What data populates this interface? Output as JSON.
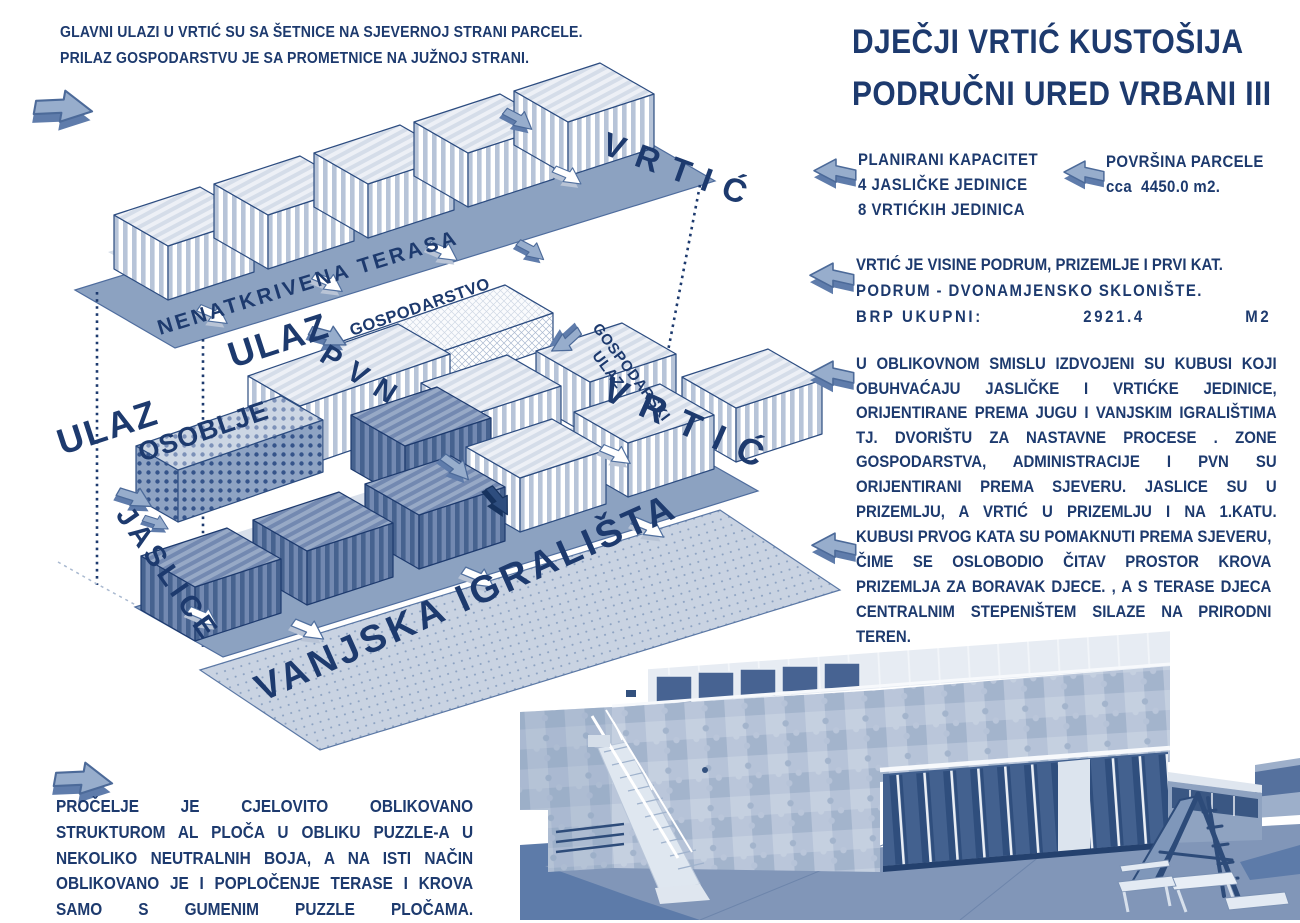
{
  "title": {
    "line1": "DJEČJI VRTIĆ KUSTOŠIJA",
    "line2": "PODRUČNI URED VRBANI III"
  },
  "notes": {
    "top_left": {
      "line1": "GLAVNI ULAZI U VRTIĆ SU SA ŠETNICE NA SJEVERNOJ STRANI PARCELE.",
      "line2": "PRILAZ GOSPODARSTVU JE SA PROMETNICE NA JUŽNOJ STRANI."
    },
    "capacity": {
      "line1": "PLANIRANI KAPACITET",
      "line2": "4 JASLIČKE JEDINICE",
      "line3": "8 VRTIĆKIH JEDINICA"
    },
    "area": {
      "line1": "POVRŠINA PARCELE",
      "line2": "cca  4450.0 m2."
    },
    "floors": {
      "line1": "VRTIĆ JE VISINE PODRUM, PRIZEMLJE I PRVI KAT.",
      "line2": "PODRUM - DVONAMJENSKO SKLONIŠTE.",
      "line3_label": "BRP UKUPNI:",
      "line3_value": "2921.4",
      "line3_unit": "M2"
    },
    "massing": {
      "text": "U OBLIKOVNOM SMISLU IZDVOJENI SU KUBUSI KOJI OBUHVAĆAJU JASLIČKE I VRTIĆKE JEDINICE, ORIJENTIRANE PREMA JUGU I VANJSKIM IGRALIŠTIMA TJ. DVORIŠTU ZA NASTAVNE PROCESE . ZONE GOSPODARSTVA, ADMINISTRACIJE I PVN SU ORIJENTIRANI PREMA SJEVERU. JASLICE SU U PRIZEMLJU, A VRTIĆ U PRIZEMLJU I NA 1.KATU."
    },
    "first_floor": {
      "text": "KUBUSI PRVOG KATA SU POMAKNUTI PREMA SJEVERU, ČIME SE OSLOBODIO ČITAV PROSTOR KROVA PRIZEMLJA ZA BORAVAK DJECE. , A S TERASE DJECA CENTRALNIM STEPENIŠTEM SILAZE NA PRIRODNI TEREN."
    },
    "facade": {
      "text": "PROČELJE JE CJELOVITO OBLIKOVANO STRUKTUROM AL PLOČA U OBLIKU PUZZLE-A U NEKOLIKO NEUTRALNIH BOJA, A NA ISTI NAČIN OBLIKOVANO JE I POPLOČENJE TERASE I KROVA SAMO S GUMENIM PUZZLE PLOČAMA."
    }
  },
  "diagram": {
    "labels": {
      "vrtic_upper": "VRTIĆ",
      "terrace": "NENATKRIVENA TERASA",
      "ulaz_left": "ULAZ",
      "ulaz_mid": "ULAZ",
      "pvn": "PVN",
      "osoblje": "OSOBLJE",
      "gospodarstvo": "GOSPODARSTVO",
      "gospodarski_line1": "GOSPODARSKI",
      "gospodarski_line2": "ULAZ",
      "vrtic_lower": "VRTIĆ",
      "jaslice": "JASLICE",
      "playgrounds": "VANJSKA IGRALIŠTA"
    }
  },
  "colors": {
    "navy_text": "#1d3a6e",
    "steel_arrow": "#97adcc",
    "plane_blue": "#8ca2c1",
    "light_stripe": "#b7c4d8",
    "photo_base": "#b6c3d8",
    "photo_dark": "#2f4e7d"
  }
}
